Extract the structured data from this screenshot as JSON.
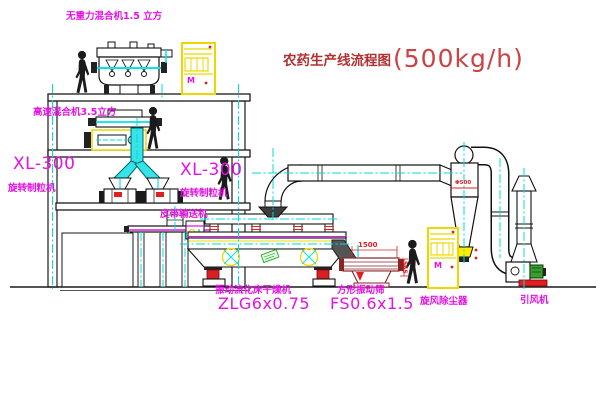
{
  "title": {
    "name": "农药生产线流程图",
    "capacity": "(500kg/h)"
  },
  "labels": {
    "gravity_mixer": "无重力混合机1.5 立方",
    "high_speed_mixer": "高速混合机3.5立方",
    "granulator_left_model": "XL-300",
    "granulator_left_name": "旋转制粒机",
    "granulator_right_model": "XL-300",
    "granulator_right_name": "旋转制粒机",
    "belt_conveyor": "皮带输送机",
    "fluid_bed_dryer_name": "振动流化床干燥机",
    "fluid_bed_dryer_model": "ZLG6x0.75",
    "vibrating_screen_name": "方形振动筛",
    "vibrating_screen_model": "FS0.6x1.5",
    "cyclone": "旋风除尘器",
    "induced_draft_fan": "引风机"
  },
  "dims": {
    "screen_length": "1500",
    "screen_height": "565",
    "cyclone_dia": "Φ500"
  },
  "cabinet": {
    "marking": "M"
  },
  "colors": {
    "label_magenta": "#e511e5",
    "title_red": "#b23030",
    "cad_cyan": "#00e5e5",
    "accent_yellow": "#ecd800",
    "accent_red": "#e02020",
    "accent_green": "#18a818",
    "screen_maroon": "#8a2424",
    "line_black": "#1a1a1a"
  }
}
